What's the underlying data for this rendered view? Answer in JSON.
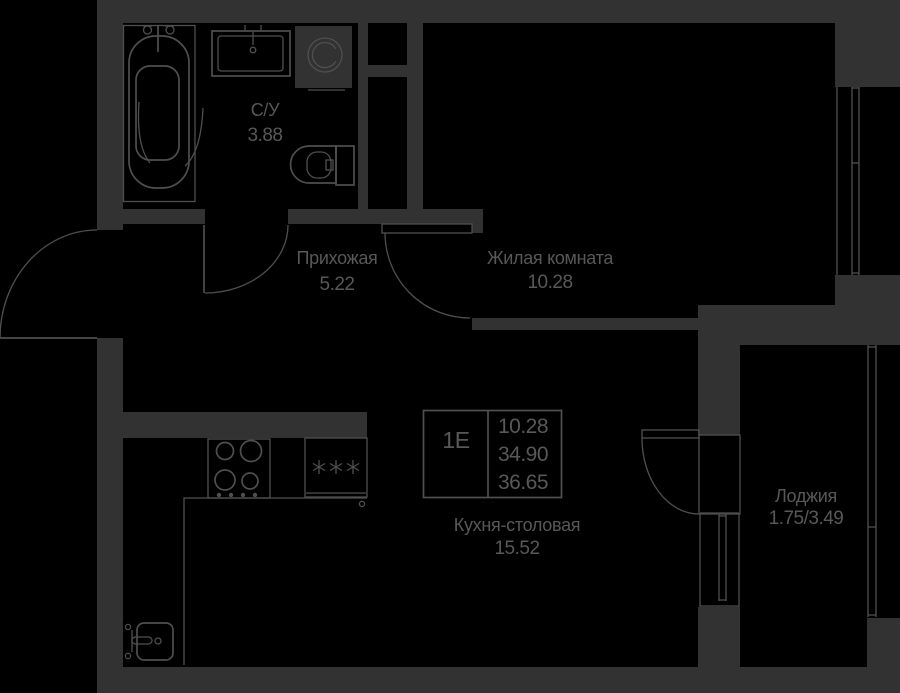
{
  "colors": {
    "background": "#000000",
    "walls": "#323232",
    "fixtures": "#4f4f4f",
    "text": "#585858"
  },
  "info_box": {
    "unit_type": "1Е",
    "living_area": "10.28",
    "total_area": "34.90",
    "total_area_with_loggia": "36.65"
  },
  "rooms": {
    "bathroom": {
      "label": "С/У",
      "area": "3.88"
    },
    "hallway": {
      "label": "Прихожая",
      "area": "5.22"
    },
    "living_room": {
      "label": "Жилая комната",
      "area": "10.28"
    },
    "kitchen_dining": {
      "label": "Кухня-столовая",
      "area": "15.52"
    },
    "loggia": {
      "label": "Лоджия",
      "area": "1.75/3.49"
    }
  }
}
